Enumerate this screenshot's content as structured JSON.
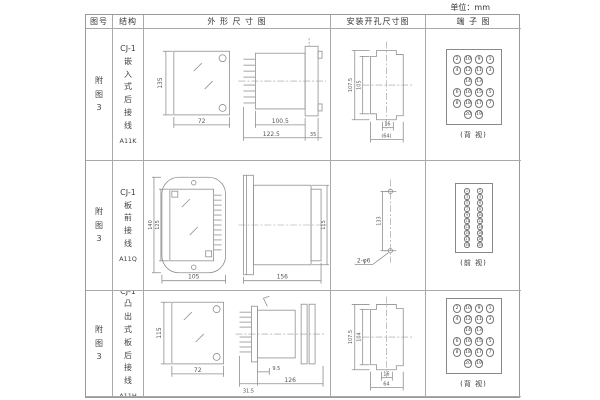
{
  "unit_label": "单位：mm",
  "header": {
    "fig": "图号",
    "struct": "结构",
    "outline": "外 形 尺 寸 图",
    "install": "安装开孔尺寸图",
    "terminal": "端 子 图"
  },
  "rows": [
    {
      "fig": "附\n图\n3",
      "struct_title": "CJ-1",
      "struct_desc": "嵌\n入\n式\n后\n接\n线",
      "struct_code": "A11K",
      "outline_dims": {
        "h": "135",
        "w": "72",
        "l1": "100.5",
        "l2": "122.5",
        "d": "35"
      },
      "install_dims": {
        "h1": "107.5",
        "h2": "105",
        "w1": "16",
        "w2": "(64)"
      },
      "terminal": {
        "cells": [
          2,
          10,
          9,
          1,
          4,
          12,
          11,
          3,
          null,
          14,
          13,
          null,
          6,
          16,
          15,
          5,
          8,
          18,
          17,
          7,
          null,
          20,
          19,
          null
        ],
        "caption": "(背 视)"
      }
    },
    {
      "fig": "附\n图\n3",
      "struct_title": "CJ-1",
      "struct_desc": "板\n前\n接\n线",
      "struct_code": "A11Q",
      "outline_dims": {
        "h1": "140",
        "h2": "125",
        "w": "105",
        "l": "156",
        "d": "115"
      },
      "install_dims": {
        "h": "133",
        "hole": "2-φ6"
      },
      "terminal": {
        "cells": [
          1,
          2,
          3,
          4,
          5,
          6,
          7,
          8,
          9,
          10,
          11,
          12,
          13,
          14,
          15,
          16,
          17,
          18,
          19,
          20
        ],
        "caption": "(前 视)"
      }
    },
    {
      "fig": "附\n图\n3",
      "struct_title": "CJ-1",
      "struct_desc": "凸\n出\n式\n板\n后\n接\n线",
      "struct_code": "A11H",
      "outline_dims": {
        "h": "115",
        "w": "72",
        "l1": "31.5",
        "l2": "9.5",
        "l3": "126"
      },
      "install_dims": {
        "h1": "107.5",
        "h2": "104",
        "w1": "16",
        "w2": "64"
      },
      "terminal": {
        "cells": [
          2,
          10,
          9,
          1,
          4,
          12,
          11,
          3,
          null,
          14,
          13,
          null,
          6,
          16,
          15,
          5,
          8,
          18,
          17,
          7,
          null,
          20,
          19,
          null
        ],
        "caption": "(背 视)"
      }
    }
  ]
}
